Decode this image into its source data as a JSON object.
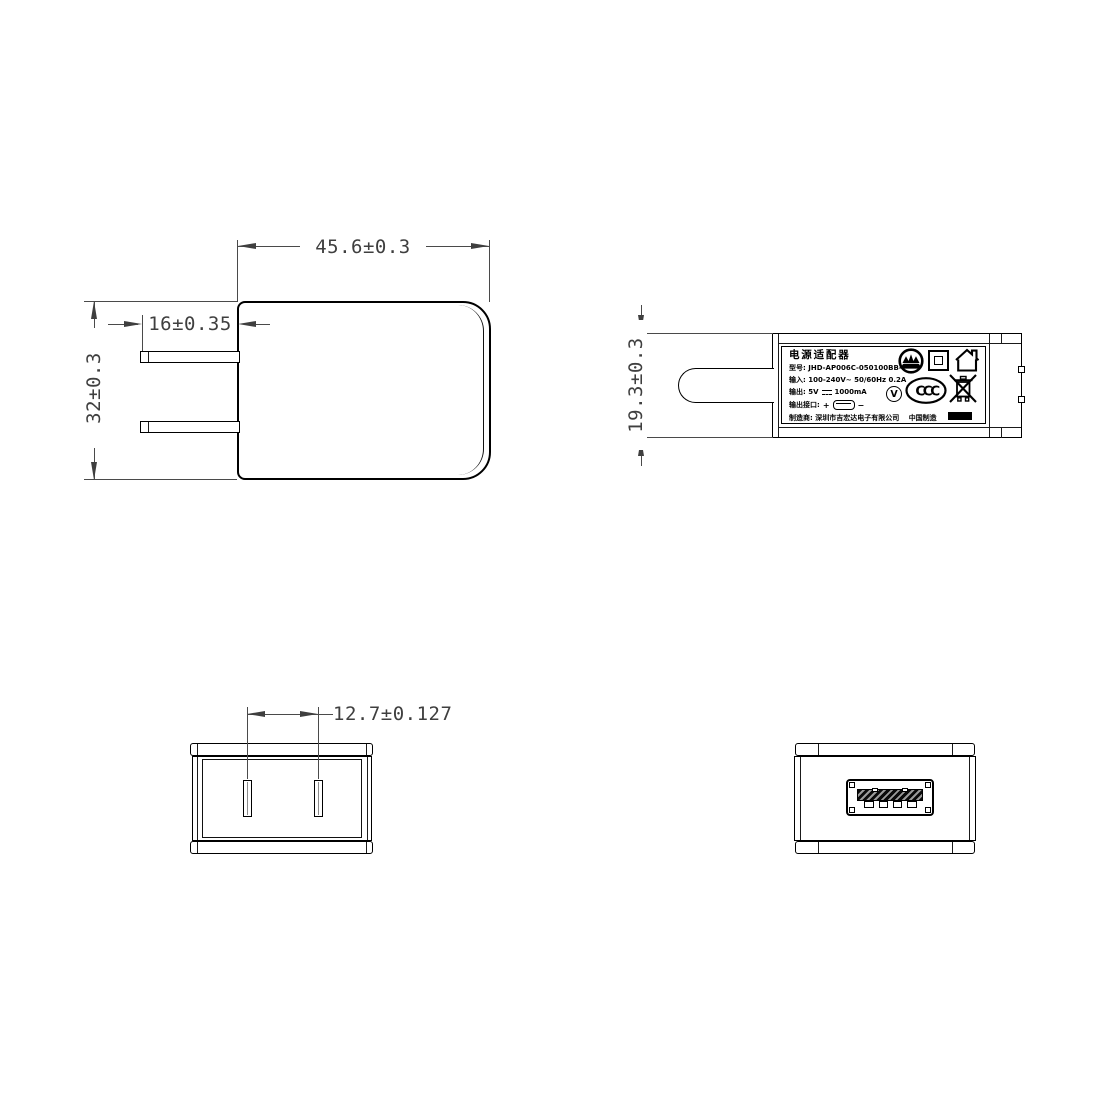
{
  "dimensions": {
    "body_width": "45.6±0.3",
    "prong_length": "16±0.35",
    "body_height": "32±0.3",
    "body_depth": "19.3±0.3",
    "prong_spacing": "12.7±0.127"
  },
  "label": {
    "title": "电源适配器",
    "model_line": "型号: JHD-AP006C-050100BB-2",
    "input_line": "输入: 100-240V~  50/60Hz  0.2A",
    "output_line_prefix": "输出: 5V",
    "output_line_suffix": "1000mA",
    "port_line_label": "输出接口:",
    "port_plus": "+",
    "port_minus": "−",
    "manufacturer_line": "制造商: 深圳市吉宏达电子有限公司",
    "made_in": "中国制造",
    "efficiency_letter": "V",
    "ccc_text": "CCC",
    "icons": [
      "certification-crown-circle",
      "class-ii-double-insulation",
      "indoor-use-only-house",
      "efficiency-level-v",
      "ccc-mark",
      "weee-crossed-bin"
    ]
  },
  "colors": {
    "object_line": "#000000",
    "dimension_line": "#4a4a4a",
    "background": "#ffffff"
  }
}
